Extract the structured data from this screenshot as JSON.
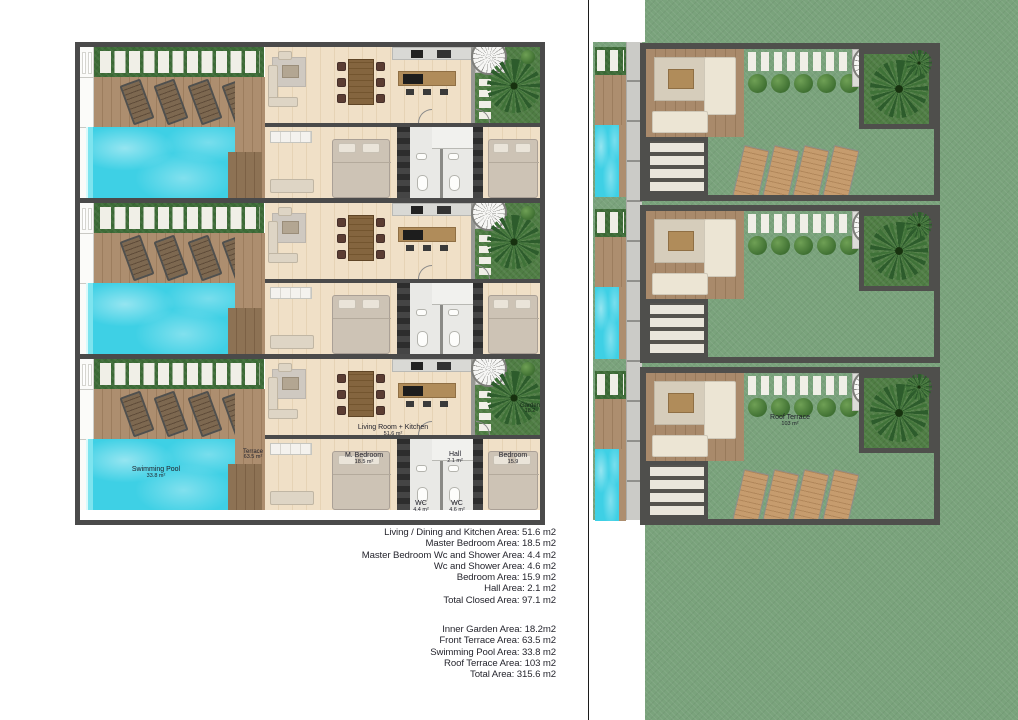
{
  "sheet": {
    "background": "#ffffff"
  },
  "palette": {
    "pool_water": "#3ed0e5",
    "deck_wood": "#a5876a",
    "strip_grass": "#3d6c37",
    "inner_garden_grass": "#4f7d44",
    "roof_grass": "#7aa37c",
    "wall_dark": "#4a4a4a",
    "stepping_stone": "#f0efe7",
    "interior_floor": "#ecd9bd"
  },
  "ground_floor": {
    "rooms": {
      "swimming_pool": {
        "label": "Swimming Pool",
        "area": "33.8 m²"
      },
      "terrace": {
        "label": "Terrace",
        "area": "63.5 m²"
      },
      "living_kitchen": {
        "label": "Living Room + Kitchen",
        "area": "51.6 m²"
      },
      "master_bedroom": {
        "label": "M. Bedroom",
        "area": "18.5 m²"
      },
      "hall": {
        "label": "Hall",
        "area": "2.1 m²"
      },
      "master_wc": {
        "label": "WC",
        "area": "4.4 m²"
      },
      "wc": {
        "label": "WC",
        "area": "4.6 m²"
      },
      "bedroom": {
        "label": "Bedroom",
        "area": "15.9"
      },
      "garden": {
        "label": "Garden",
        "area": "18.2"
      }
    }
  },
  "roof": {
    "roof_terrace": {
      "label": "Roof Terrace",
      "area": "103 m²"
    }
  },
  "area_summary": {
    "closed": [
      "Living / Dining and Kitchen Area: 51.6 m2",
      "Master Bedroom Area: 18.5 m2",
      "Master Bedroom Wc and Shower Area: 4.4 m2",
      "Wc and Shower Area: 4.6 m2",
      "Bedroom Area: 15.9 m2",
      "Hall Area: 2.1 m2",
      "Total Closed Area: 97.1 m2"
    ],
    "open": [
      "Inner Garden Area: 18.2m2",
      "Front Terrace Area: 63.5 m2",
      "Swimming Pool Area: 33.8 m2",
      "Roof Terrace Area: 103 m2",
      "Total Area: 315.6 m2"
    ]
  }
}
